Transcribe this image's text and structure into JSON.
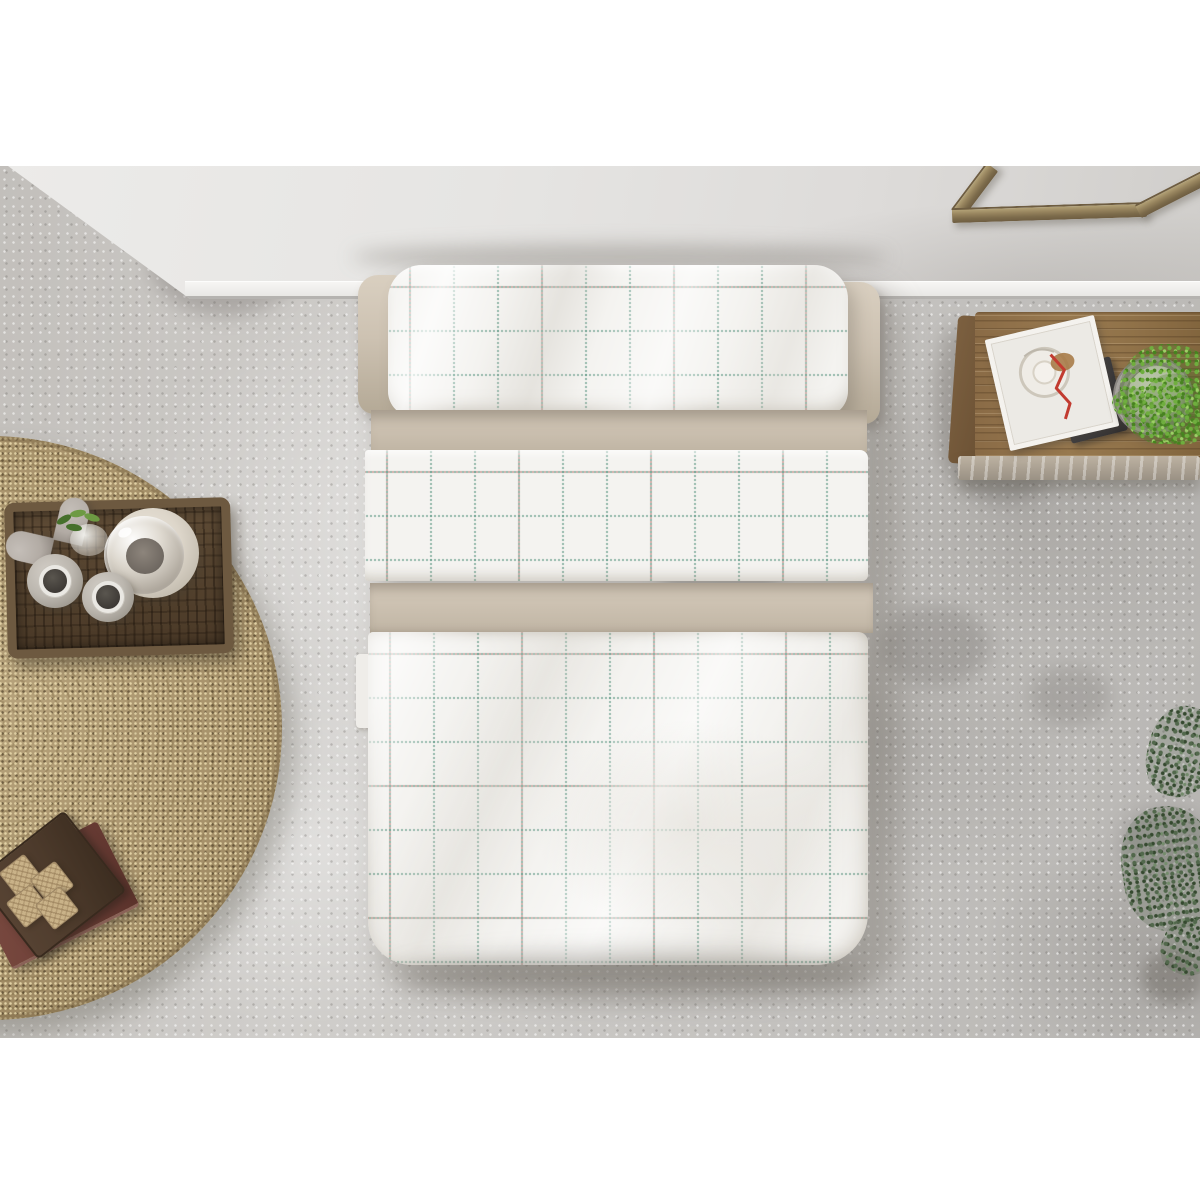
{
  "image": {
    "kind": "top-down product photograph of a bedroom",
    "subject": "white duvet and pillow set with stitched check grid pattern and taupe reverse bands",
    "text_visible": "none"
  },
  "palette": {
    "letterbox": "#ffffff",
    "wall-light": "#e9e8e6",
    "wall-dark": "#cfcdca",
    "floor-base": "#c8c5c1",
    "rug-base": "#ab9670",
    "tray-brown": "#54422e",
    "tray-rim": "#6d5940",
    "stone-grey": "#b2aba4",
    "plant-green": "#6d9a43",
    "plant-green-dark": "#46702c",
    "plate-cream": "#ddd6ca",
    "vase-grey": "#bcb7af",
    "vase-hole": "#3e3a36",
    "book-maroon": "#6e4038",
    "board-brown": "#4c3a2b",
    "cube-tan": "#c9b288",
    "bed-white": "#f4f3f0",
    "bed-beige": "#cdc2b2",
    "bed-beige-dark": "#b4a996",
    "grid-teal": "rgba(104,158,140,0.6)",
    "grid-pink": "rgba(187,120,115,0.5)",
    "bench-wood": "#8f7049",
    "bench-wood-dark": "#6b5134",
    "bench-edge": "#b5aa99",
    "frame-bronze": "#97845e",
    "frame-bronze-dark": "#6e5d41",
    "magazine-white": "#eceae5",
    "magazine-red": "#c23b30",
    "notebook-dark": "#3b3a3c",
    "pot-white": "#d8d5cf"
  },
  "bedding_pattern": {
    "type": "dotted check grid",
    "square_size_px": 44,
    "line_style": "dotted stitch lines",
    "line_colors": [
      "teal-green",
      "dusty pink"
    ]
  },
  "scene_objects": [
    {
      "name": "back-wall",
      "description": "pale grey wall band across the top with white skirting board"
    },
    {
      "name": "concrete-floor",
      "description": "mottled grey polished concrete floor"
    },
    {
      "name": "picture-frame",
      "description": "bronze frame corner leaning against wall, cropped at top right"
    },
    {
      "name": "bed",
      "description": "double bed seen from above: white grid pillow bolster with taupe end caps, taupe turn-down band, white grid sheet fold, wide taupe band, large white grid duvet"
    },
    {
      "name": "jute-rug",
      "description": "round braided jute rug, partially cropped at left"
    },
    {
      "name": "wicker-tray",
      "description": "dark rattan tray on rug holding decor"
    },
    {
      "name": "heart-ornament",
      "description": "grey stone heart"
    },
    {
      "name": "mini-plant",
      "description": "small green sprigs in a glass cup"
    },
    {
      "name": "glass-dome",
      "description": "glass decanter on cream ceramic plate"
    },
    {
      "name": "vases",
      "count": 2,
      "description": "two grey ceramic vases with dark round openings"
    },
    {
      "name": "book-stack",
      "description": "maroon book with dark wooden board on top"
    },
    {
      "name": "cube-coasters",
      "count": 4,
      "description": "four woven tan cubes arranged two by two"
    },
    {
      "name": "wooden-bench",
      "description": "low wooden bench along right wall"
    },
    {
      "name": "magazine",
      "description": "white magazine with circular artwork and red zigzag line on a dark notebook"
    },
    {
      "name": "potted-plant",
      "description": "bright green plant in white pot on grey rope mat"
    },
    {
      "name": "floor-plant",
      "description": "dark green trailing plant entering from bottom right edge"
    }
  ]
}
